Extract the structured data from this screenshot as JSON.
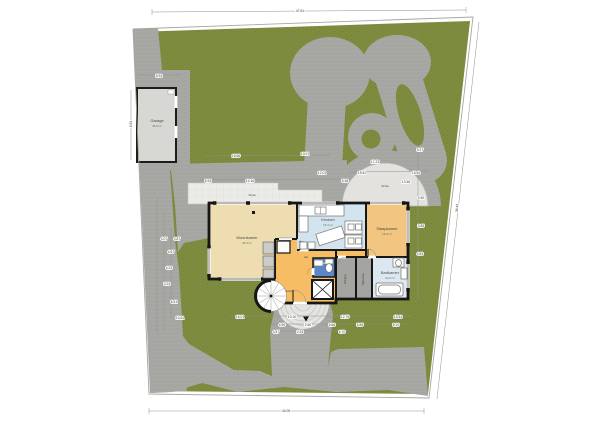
{
  "plan": {
    "title": "Situatie / begane grond plattegrond",
    "rooms": {
      "garage": {
        "name": "Garage",
        "area": "35.9 m²"
      },
      "woonkamer": {
        "name": "Woonkamer",
        "area": "44.9 m²"
      },
      "keuken": {
        "name": "Keuken",
        "area": "16.4 m²"
      },
      "slaapkamer": {
        "name": "Slaapkamer",
        "area": "15.8 m²"
      },
      "hal": {
        "name": "Hal"
      },
      "entree": {
        "name": "Entree"
      },
      "toilet": {
        "name": "Toilet"
      },
      "berging": {
        "name": "Berging"
      },
      "bijkeuken": {
        "name": "Bijkeuken"
      },
      "badkamer": {
        "name": "Badkamer",
        "area": "10.2 m²"
      },
      "terras_rond": {
        "name": "Terras"
      },
      "terras": {
        "name": "Terras"
      }
    },
    "dimensions": [
      {
        "x": 300,
        "y": 11,
        "t": "47.61"
      },
      {
        "x": 159,
        "y": 76,
        "t": "5.93"
      },
      {
        "x": 131,
        "y": 124,
        "t": "8.93",
        "r": -90
      },
      {
        "x": 236,
        "y": 156,
        "t": "16.66"
      },
      {
        "x": 305,
        "y": 154,
        "t": "10.01"
      },
      {
        "x": 208,
        "y": 181,
        "t": "6.93"
      },
      {
        "x": 250,
        "y": 181,
        "t": "14.16"
      },
      {
        "x": 322,
        "y": 173,
        "t": "12.01"
      },
      {
        "x": 345,
        "y": 181,
        "t": "5.38"
      },
      {
        "x": 375,
        "y": 162,
        "t": "17.23"
      },
      {
        "x": 362,
        "y": 173,
        "t": "15.81"
      },
      {
        "x": 416,
        "y": 173,
        "t": "15.44"
      },
      {
        "x": 406,
        "y": 182,
        "t": "13.48"
      },
      {
        "x": 164,
        "y": 239,
        "t": "4.07"
      },
      {
        "x": 177,
        "y": 239,
        "t": "4.87"
      },
      {
        "x": 171,
        "y": 252,
        "t": "4.67"
      },
      {
        "x": 169,
        "y": 268,
        "t": "4.23"
      },
      {
        "x": 167,
        "y": 284,
        "t": "3.23"
      },
      {
        "x": 174,
        "y": 302,
        "t": "6.41"
      },
      {
        "x": 180,
        "y": 318,
        "t": "10.61"
      },
      {
        "x": 420,
        "y": 150,
        "t": "9.27"
      },
      {
        "x": 421,
        "y": 198,
        "t": "4.90"
      },
      {
        "x": 421,
        "y": 226,
        "t": "3.85"
      },
      {
        "x": 420,
        "y": 254,
        "t": "4.83"
      },
      {
        "x": 457,
        "y": 208,
        "t": "38.43",
        "r": -87
      },
      {
        "x": 240,
        "y": 317,
        "t": "16.01"
      },
      {
        "x": 292,
        "y": 317,
        "t": "10.10"
      },
      {
        "x": 345,
        "y": 317,
        "t": "12.75"
      },
      {
        "x": 398,
        "y": 317,
        "t": "15.44"
      },
      {
        "x": 282,
        "y": 325,
        "t": "4.90"
      },
      {
        "x": 308,
        "y": 325,
        "t": "2.60"
      },
      {
        "x": 332,
        "y": 325,
        "t": "6.66"
      },
      {
        "x": 360,
        "y": 325,
        "t": "5.85"
      },
      {
        "x": 396,
        "y": 325,
        "t": "8.10"
      },
      {
        "x": 276,
        "y": 332,
        "t": "4.47"
      },
      {
        "x": 300,
        "y": 332,
        "t": "2.53"
      },
      {
        "x": 342,
        "y": 332,
        "t": "6.70"
      },
      {
        "x": 286,
        "y": 411,
        "t": "44.05"
      }
    ],
    "colors": {
      "grass": "#7d8c3e",
      "grass_dot": "#748236",
      "paving": "#a9a9a6",
      "paving_line": "#9b9b97",
      "terrace": "#ebebe8",
      "tile_line": "#d9d9d4",
      "terrace_round": "#e3e2de",
      "garage_fill": "#d7d7d4",
      "living": "#efddb2",
      "hall": "#f6bd65",
      "kitchen": "#d3e4ef",
      "bedroom": "#f2c681",
      "toilet": "#5b87c8",
      "bathroom": "#dbe7f1",
      "storage": "#a4a4a1",
      "wall": "#161616"
    }
  }
}
